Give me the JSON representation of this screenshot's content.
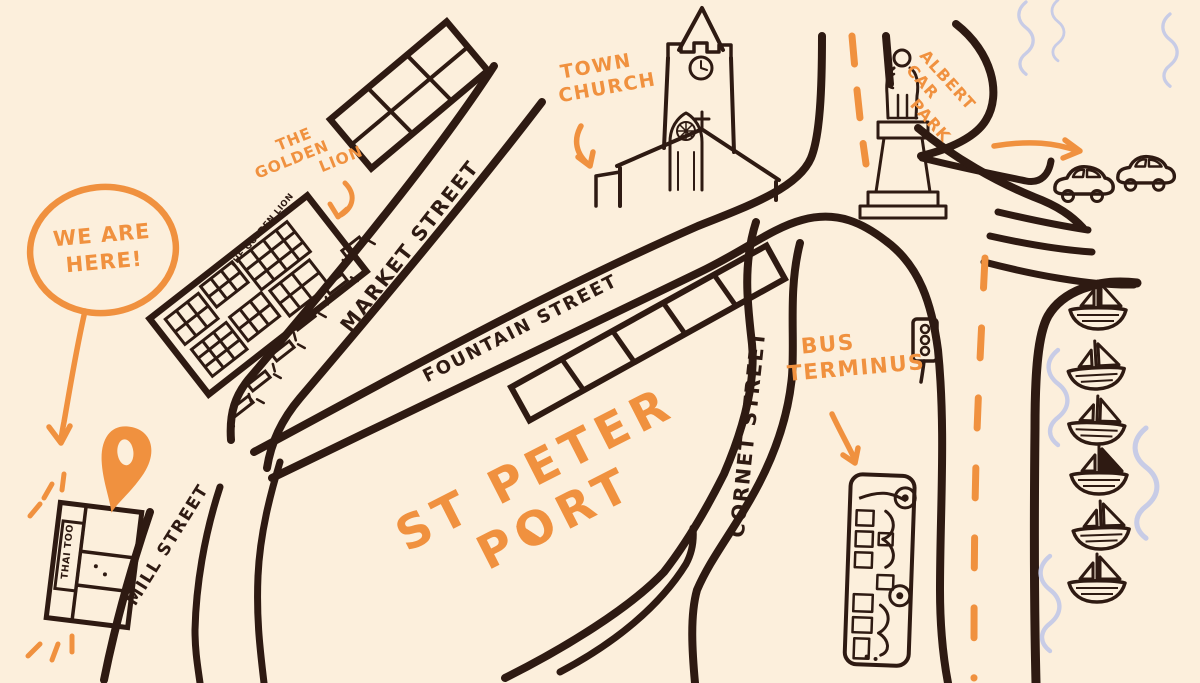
{
  "page": {
    "width": 1200,
    "height": 683
  },
  "palette": {
    "background": "#fcefdc",
    "ink": "#2e1a12",
    "accent_orange": "#f0913f",
    "water_blue": "#c8cce6"
  },
  "title": {
    "line1": "ST PETER",
    "line2": "PORT"
  },
  "marker_bubble": {
    "line1": "WE ARE",
    "line2": "HERE!"
  },
  "labels": {
    "golden_lion": {
      "line1": "THE",
      "line2": "GOLDEN",
      "line3": "LION"
    },
    "golden_lion_building_sign": "THE GOLDEN LION",
    "town_church": {
      "line1": "TOWN",
      "line2": "CHURCH"
    },
    "albert_car_park": {
      "line1": "ALBERT",
      "line2": "CAR",
      "line3": "PARK"
    },
    "bus_terminus": {
      "line1": "BUS",
      "line2": "TERMINUS"
    },
    "thai_too": "THAI TOO"
  },
  "streets": {
    "market": "MARKET STREET",
    "fountain": "FOUNTAIN STREET",
    "cornet": "CORNET STREET",
    "mill": "MILL STREET"
  },
  "icons": [
    "location-pin",
    "speech-bubble",
    "church-building",
    "statue-monument",
    "traffic-light",
    "bus",
    "car",
    "sailboat",
    "water-waves",
    "cafe-table",
    "sparkle-dashes",
    "arrow"
  ]
}
